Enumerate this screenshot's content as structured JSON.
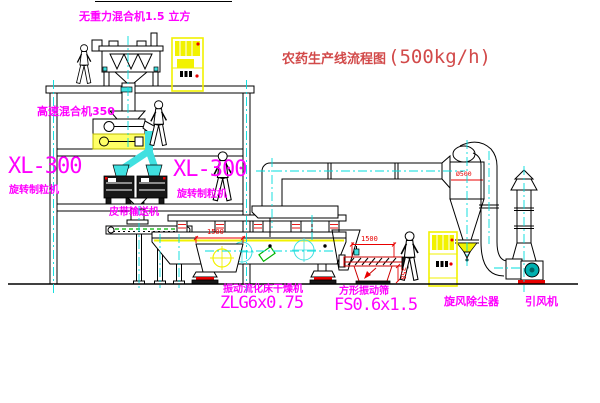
{
  "diagram": {
    "title": {
      "name_cn": "农药生产线流程图",
      "capacity": "(500kg/h)"
    },
    "equipment": {
      "gravity_mixer": {
        "label": "无重力混合机1.5 立方"
      },
      "high_speed_mixer": {
        "label": "高速混合机350"
      },
      "granulator_left": {
        "model": "XL-300",
        "name": "旋转制粒机"
      },
      "granulator_right": {
        "model": "XL-300",
        "name": "旋转制粒机"
      },
      "belt_conveyor": {
        "name": "皮带输送机"
      },
      "fluid_bed_dryer": {
        "name": "振动流化床干燥机",
        "model": "ZLG6x0.75"
      },
      "vibrating_screen": {
        "name": "方形振动筛",
        "model": "FS0.6x1.5"
      },
      "cyclone": {
        "name": "旋风除尘器"
      },
      "fan": {
        "name": "引风机"
      }
    },
    "dimensions": {
      "dryer_inlet": "1500",
      "screen_length": "1500",
      "screen_height": "350",
      "cyclone_diameter": "Ø500"
    },
    "colors": {
      "label_magenta": "#ff00ff",
      "title_red": "#d24a4a",
      "centerline": "#00dcdc",
      "duct_cyan": "#40e0e0",
      "highlight": "#f2f200",
      "accent_red": "#e80000",
      "hatch_green": "#00b400",
      "fan_teal": "#00b0b0",
      "line": "#000000"
    }
  }
}
